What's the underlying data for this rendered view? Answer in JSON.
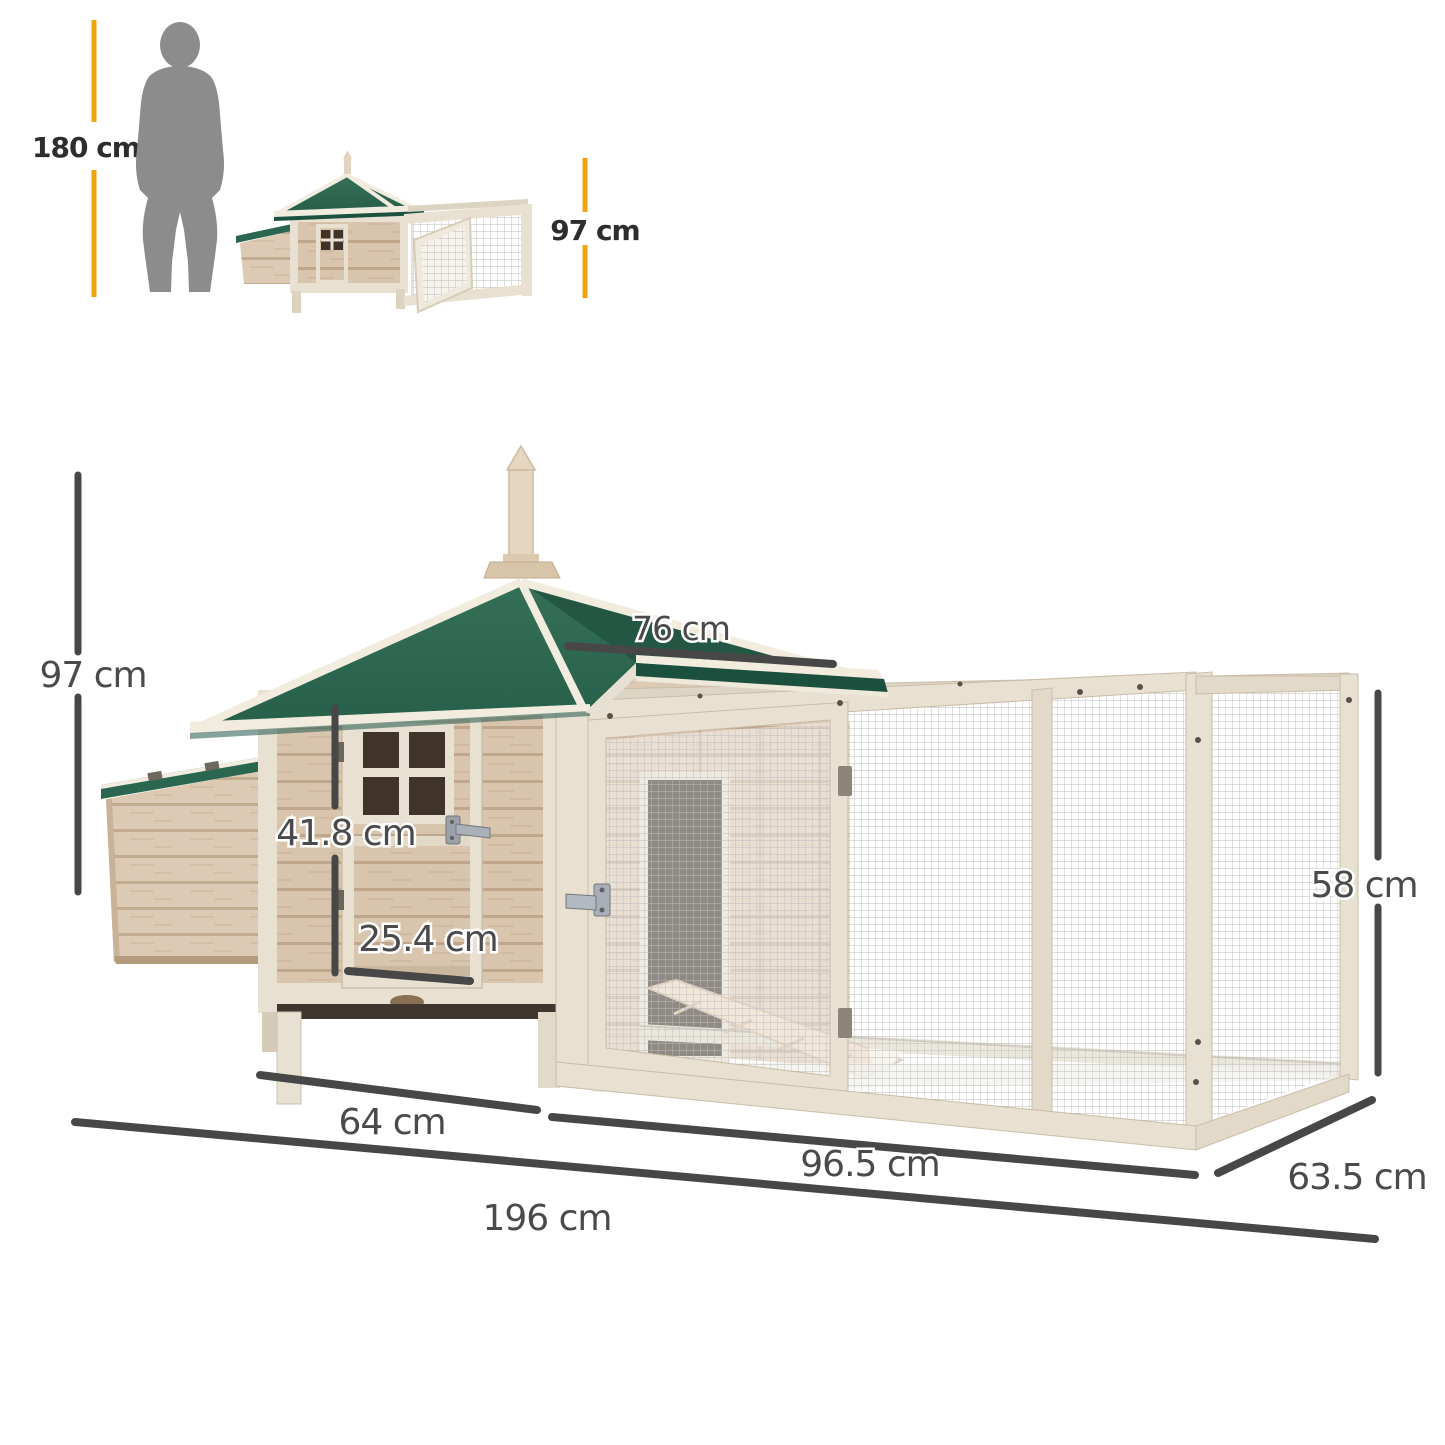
{
  "scale_comparison": {
    "person_height_label": "180 cm",
    "product_height_label": "97 cm"
  },
  "dimensions": {
    "roof_side": "76 cm",
    "overall_height": "97 cm",
    "door_height": "41.8 cm",
    "door_width": "25.4 cm",
    "run_height": "58 cm",
    "house_depth": "64 cm",
    "run_length": "96.5 cm",
    "run_depth": "63.5 cm",
    "overall_length": "196 cm"
  },
  "colors": {
    "accent_yellow": "#F1A40F",
    "roof_green": "#2E6B54",
    "roof_fascia_green": "#1B4F3E",
    "dimension_gray": "#474747",
    "label_gray": "#4A4A4A",
    "wood_light": "#D9C5AE",
    "trim_cream": "#E8E0D1",
    "silhouette_gray": "#8C8C8C"
  }
}
